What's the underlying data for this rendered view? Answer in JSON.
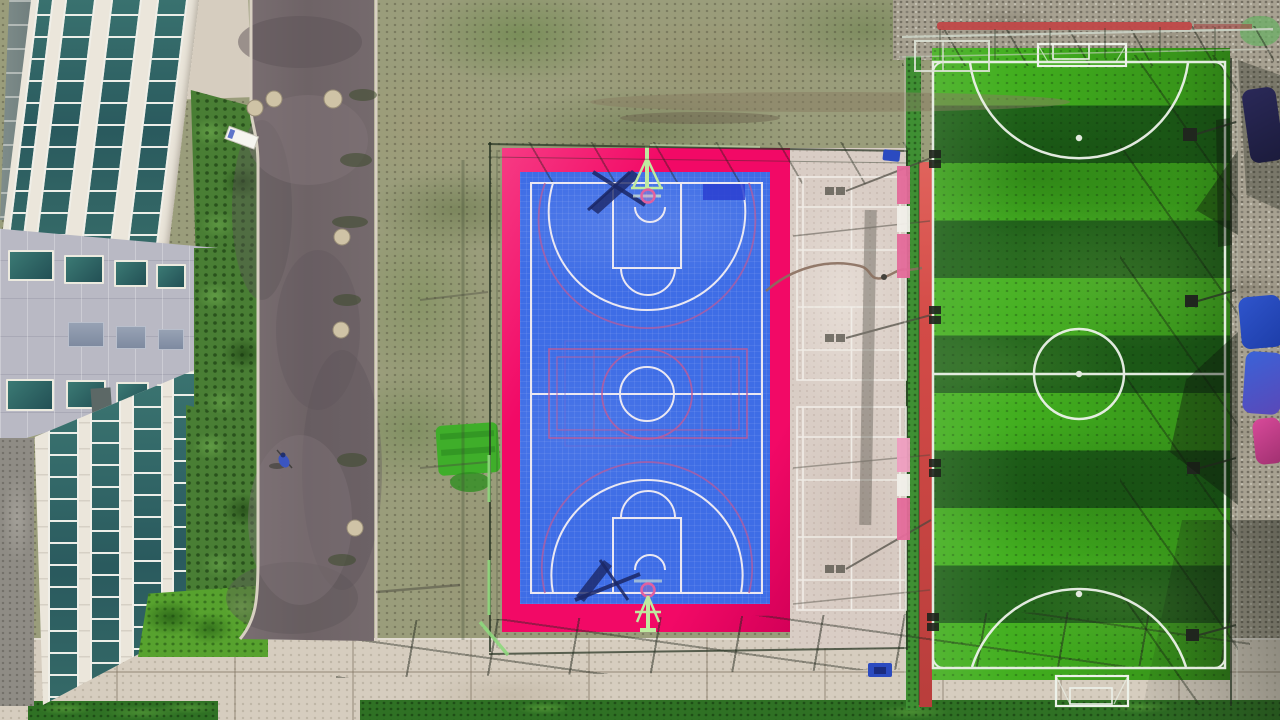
{
  "scene": {
    "description": "Aerial drone photograph, top-down view of a campus sports complex: office building with glass curtain walls at left, curved asphalt road, scrubby grass, a fenced blue basketball court with vivid pink apron, tan badminton courts, and a striped green artificial-turf soccer pitch with goals, floodlights and colorful tents along the right edge",
    "regions": {
      "building": {
        "label": "office building seen from above with glass curtain-wall strips and grey panel facade"
      },
      "road": {
        "label": "dark asphalt road curving around the building with manhole covers"
      },
      "scrub": {
        "label": "patchy scrub grass and dirt ground"
      },
      "basketball": {
        "label": "blue basketball court with white markings and pink apron inside a fence"
      },
      "badminton": {
        "label": "tan concrete strip with white badminton court lines and pole shadows"
      },
      "soccer": {
        "label": "artificial turf soccer pitch with light and dark green mowing stripes"
      },
      "walkway": {
        "label": "concrete walkway with fence shadows"
      },
      "grass_strip": {
        "label": "dark green grass strip along the bottom"
      },
      "gravel": {
        "label": "grey gravel ground at top right and right edge"
      },
      "tents": {
        "label": "blue, indigo and pink tents or banners along the right fence"
      }
    },
    "objects": [
      "basketball-hoop-top",
      "basketball-hoop-bottom",
      "soccer-goal-top",
      "soccer-goal-bottom",
      "center-circle",
      "three-point-arcs",
      "volleyball-overlay-lines",
      "floodlights",
      "garden-hose",
      "manhole-covers",
      "pedestrian-with-bicycle",
      "white-sign",
      "turf-rolls",
      "red-track-strip"
    ]
  },
  "colors": {
    "terrain_scrub": "#9a9d7b",
    "gravel": "#a7a191",
    "road_asphalt": "#746a6d",
    "road_dark": "#5d5458",
    "curb": "#d8d0c2",
    "pavement": "#d6cdbf",
    "pavement_joint": "#b0a48f",
    "grass_strip": "#2f7124",
    "grass_light": "#4f9a33",
    "lawn": "#57a22e",
    "hedge": "#497e34",
    "court_blue": "#3e6de6",
    "court_blue_light": "#5b84ee",
    "apron_pink": "#f20966",
    "line_white": "#ebe8f2",
    "line_pink": "#c05a96",
    "overlay_violet": "#7a6ad0",
    "hoop_green": "#bfeaa0",
    "hoop_ring_pink": "#e060a0",
    "shadow_navy": "#1b2766",
    "badminton_surface": "#d9cdc5",
    "badminton_line": "#f2efe9",
    "shadow_gray": "#4a483f",
    "field_green_light": "#41ae1e",
    "field_green_dark": "#1e6118",
    "field_line_white": "#edf2ea",
    "track_red": "#d34b47",
    "fence_green_strip": "#3f8f33",
    "fence_dark": "#22301f",
    "fence_rail_light": "#ccd3c6",
    "red_bar": "#c04848",
    "board_pink": "#e46a9a",
    "board_white": "#f2f0ea",
    "tent_navy": "#332e78",
    "tent_blue": "#2f55cc",
    "tent_indigo": "#5a48b8",
    "tent_pink": "#d84a9a",
    "building_white": "#ebe6db",
    "building_gray": "#b9b9c4",
    "glass_teal": "#2e6360",
    "glass_frame": "#f0efe8",
    "panel_slate": "#8f9aad",
    "roof_slate": "#7d8a88",
    "concrete_dark": "#8f8c85",
    "person_blue": "#3a55c0",
    "hose_brown": "#8a6f5e",
    "turf_patch": "#3fae2a",
    "glint_green": "#8fd97e",
    "blue_box": "#2b4bc0",
    "manhole": "#cfc3a6"
  }
}
